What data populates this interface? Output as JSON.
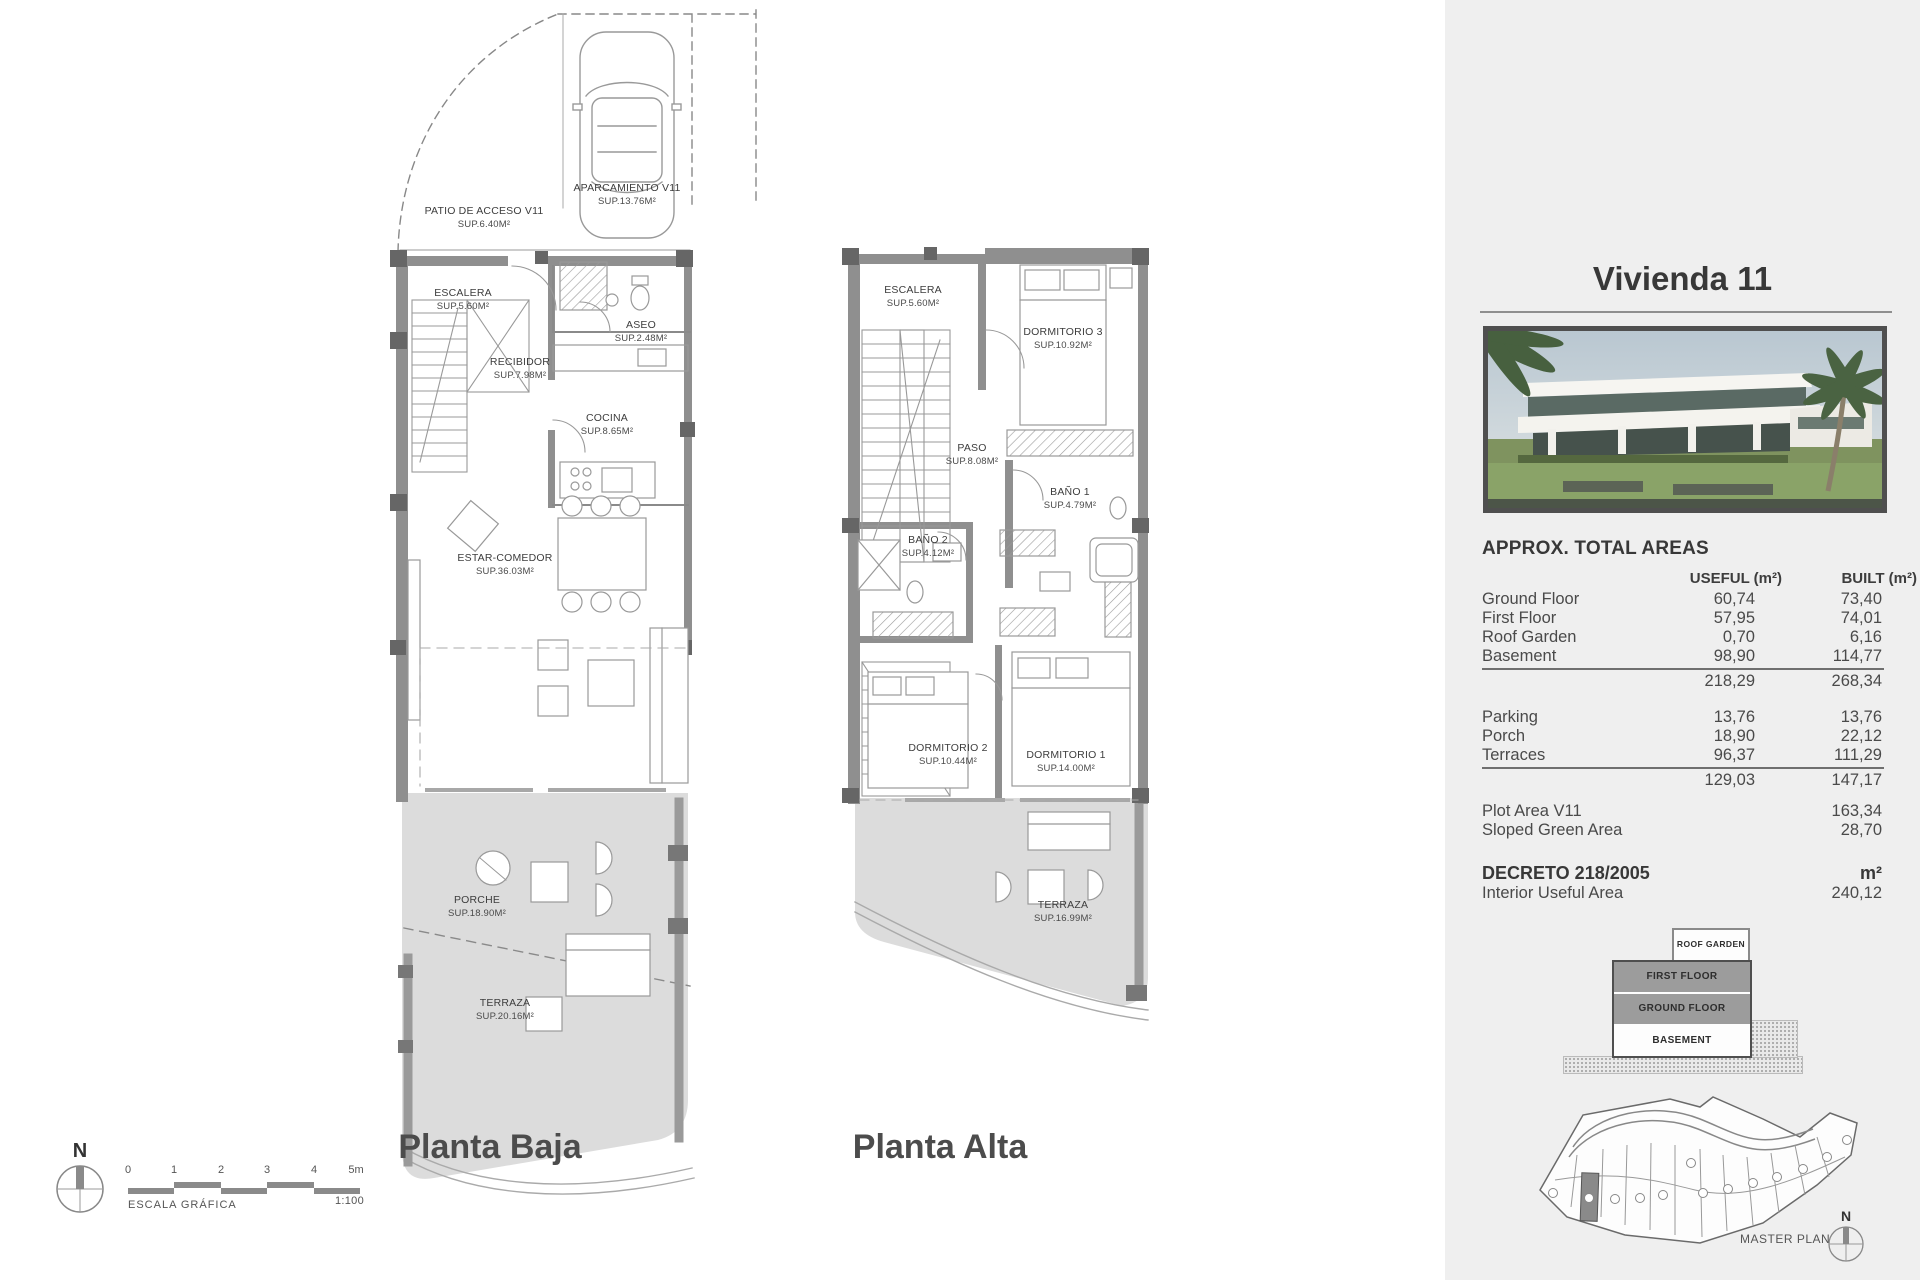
{
  "plans": {
    "baja": {
      "title": "Planta Baja",
      "rooms": [
        {
          "name": "PATIO DE ACCESO V11",
          "sup": "SUP.6.40M²"
        },
        {
          "name": "APARCAMIENTO V11",
          "sup": "SUP.13.76M²"
        },
        {
          "name": "ESCALERA",
          "sup": "SUP.5.60M²"
        },
        {
          "name": "ASEO",
          "sup": "SUP.2.48M²"
        },
        {
          "name": "RECIBIDOR",
          "sup": "SUP.7.98M²"
        },
        {
          "name": "COCINA",
          "sup": "SUP.8.65M²"
        },
        {
          "name": "ESTAR-COMEDOR",
          "sup": "SUP.36.03M²"
        },
        {
          "name": "PORCHE",
          "sup": "SUP.18.90M²"
        },
        {
          "name": "TERRAZA",
          "sup": "SUP.20.16M²"
        }
      ]
    },
    "alta": {
      "title": "Planta Alta",
      "rooms": [
        {
          "name": "ESCALERA",
          "sup": "SUP.5.60M²"
        },
        {
          "name": "DORMITORIO 3",
          "sup": "SUP.10.92M²"
        },
        {
          "name": "PASO",
          "sup": "SUP.8.08M²"
        },
        {
          "name": "BAÑO 1",
          "sup": "SUP.4.79M²"
        },
        {
          "name": "BAÑO 2",
          "sup": "SUP.4.12M²"
        },
        {
          "name": "DORMITORIO 2",
          "sup": "SUP.10.44M²"
        },
        {
          "name": "DORMITORIO 1",
          "sup": "SUP.14.00M²"
        },
        {
          "name": "TERRAZA",
          "sup": "SUP.16.99M²"
        }
      ]
    }
  },
  "scale": {
    "north": "N",
    "ticks": [
      "0",
      "1",
      "2",
      "3",
      "4",
      "5m"
    ],
    "label": "ESCALA GRÁFICA",
    "ratio": "1:100"
  },
  "sidebar": {
    "title": "Vivienda 11",
    "areas_heading": "APPROX. TOTAL AREAS",
    "col_useful": "USEFUL (m²)",
    "col_built": "BUILT (m²)",
    "rows": [
      {
        "label": "Ground Floor",
        "useful": "60,74",
        "built": "73,40"
      },
      {
        "label": "First Floor",
        "useful": "57,95",
        "built": "74,01"
      },
      {
        "label": "Roof Garden",
        "useful": "0,70",
        "built": "6,16"
      },
      {
        "label": "Basement",
        "useful": "98,90",
        "built": "114,77"
      }
    ],
    "subtotal1": {
      "useful": "218,29",
      "built": "268,34"
    },
    "rows2": [
      {
        "label": "Parking",
        "useful": "13,76",
        "built": "13,76"
      },
      {
        "label": "Porch",
        "useful": "18,90",
        "built": "22,12"
      },
      {
        "label": "Terraces",
        "useful": "96,37",
        "built": "111,29"
      }
    ],
    "subtotal2": {
      "useful": "129,03",
      "built": "147,17"
    },
    "extra_rows": [
      {
        "label": "Plot Area V11",
        "value": "163,34"
      },
      {
        "label": "Sloped Green Area",
        "value": "28,70"
      }
    ],
    "decreto": {
      "label": "DECRETO 218/2005",
      "unit": "m²",
      "row_label": "Interior Useful Area",
      "row_value": "240,12"
    },
    "stack": {
      "roof": "ROOF GARDEN",
      "first": "FIRST FLOOR",
      "ground": "GROUND FLOOR",
      "basement": "BASEMENT"
    },
    "masterplan_label": "MASTER PLAN",
    "masterplan_highlighted_plot": "V11",
    "north": "N"
  },
  "colors": {
    "sidebar_bg": "#efefef",
    "wall_gray": "#8f8f8f",
    "terrace_fill": "#dcdcdc",
    "stack_band": "#9c9c9c",
    "text_dark": "#3d3d3d"
  }
}
